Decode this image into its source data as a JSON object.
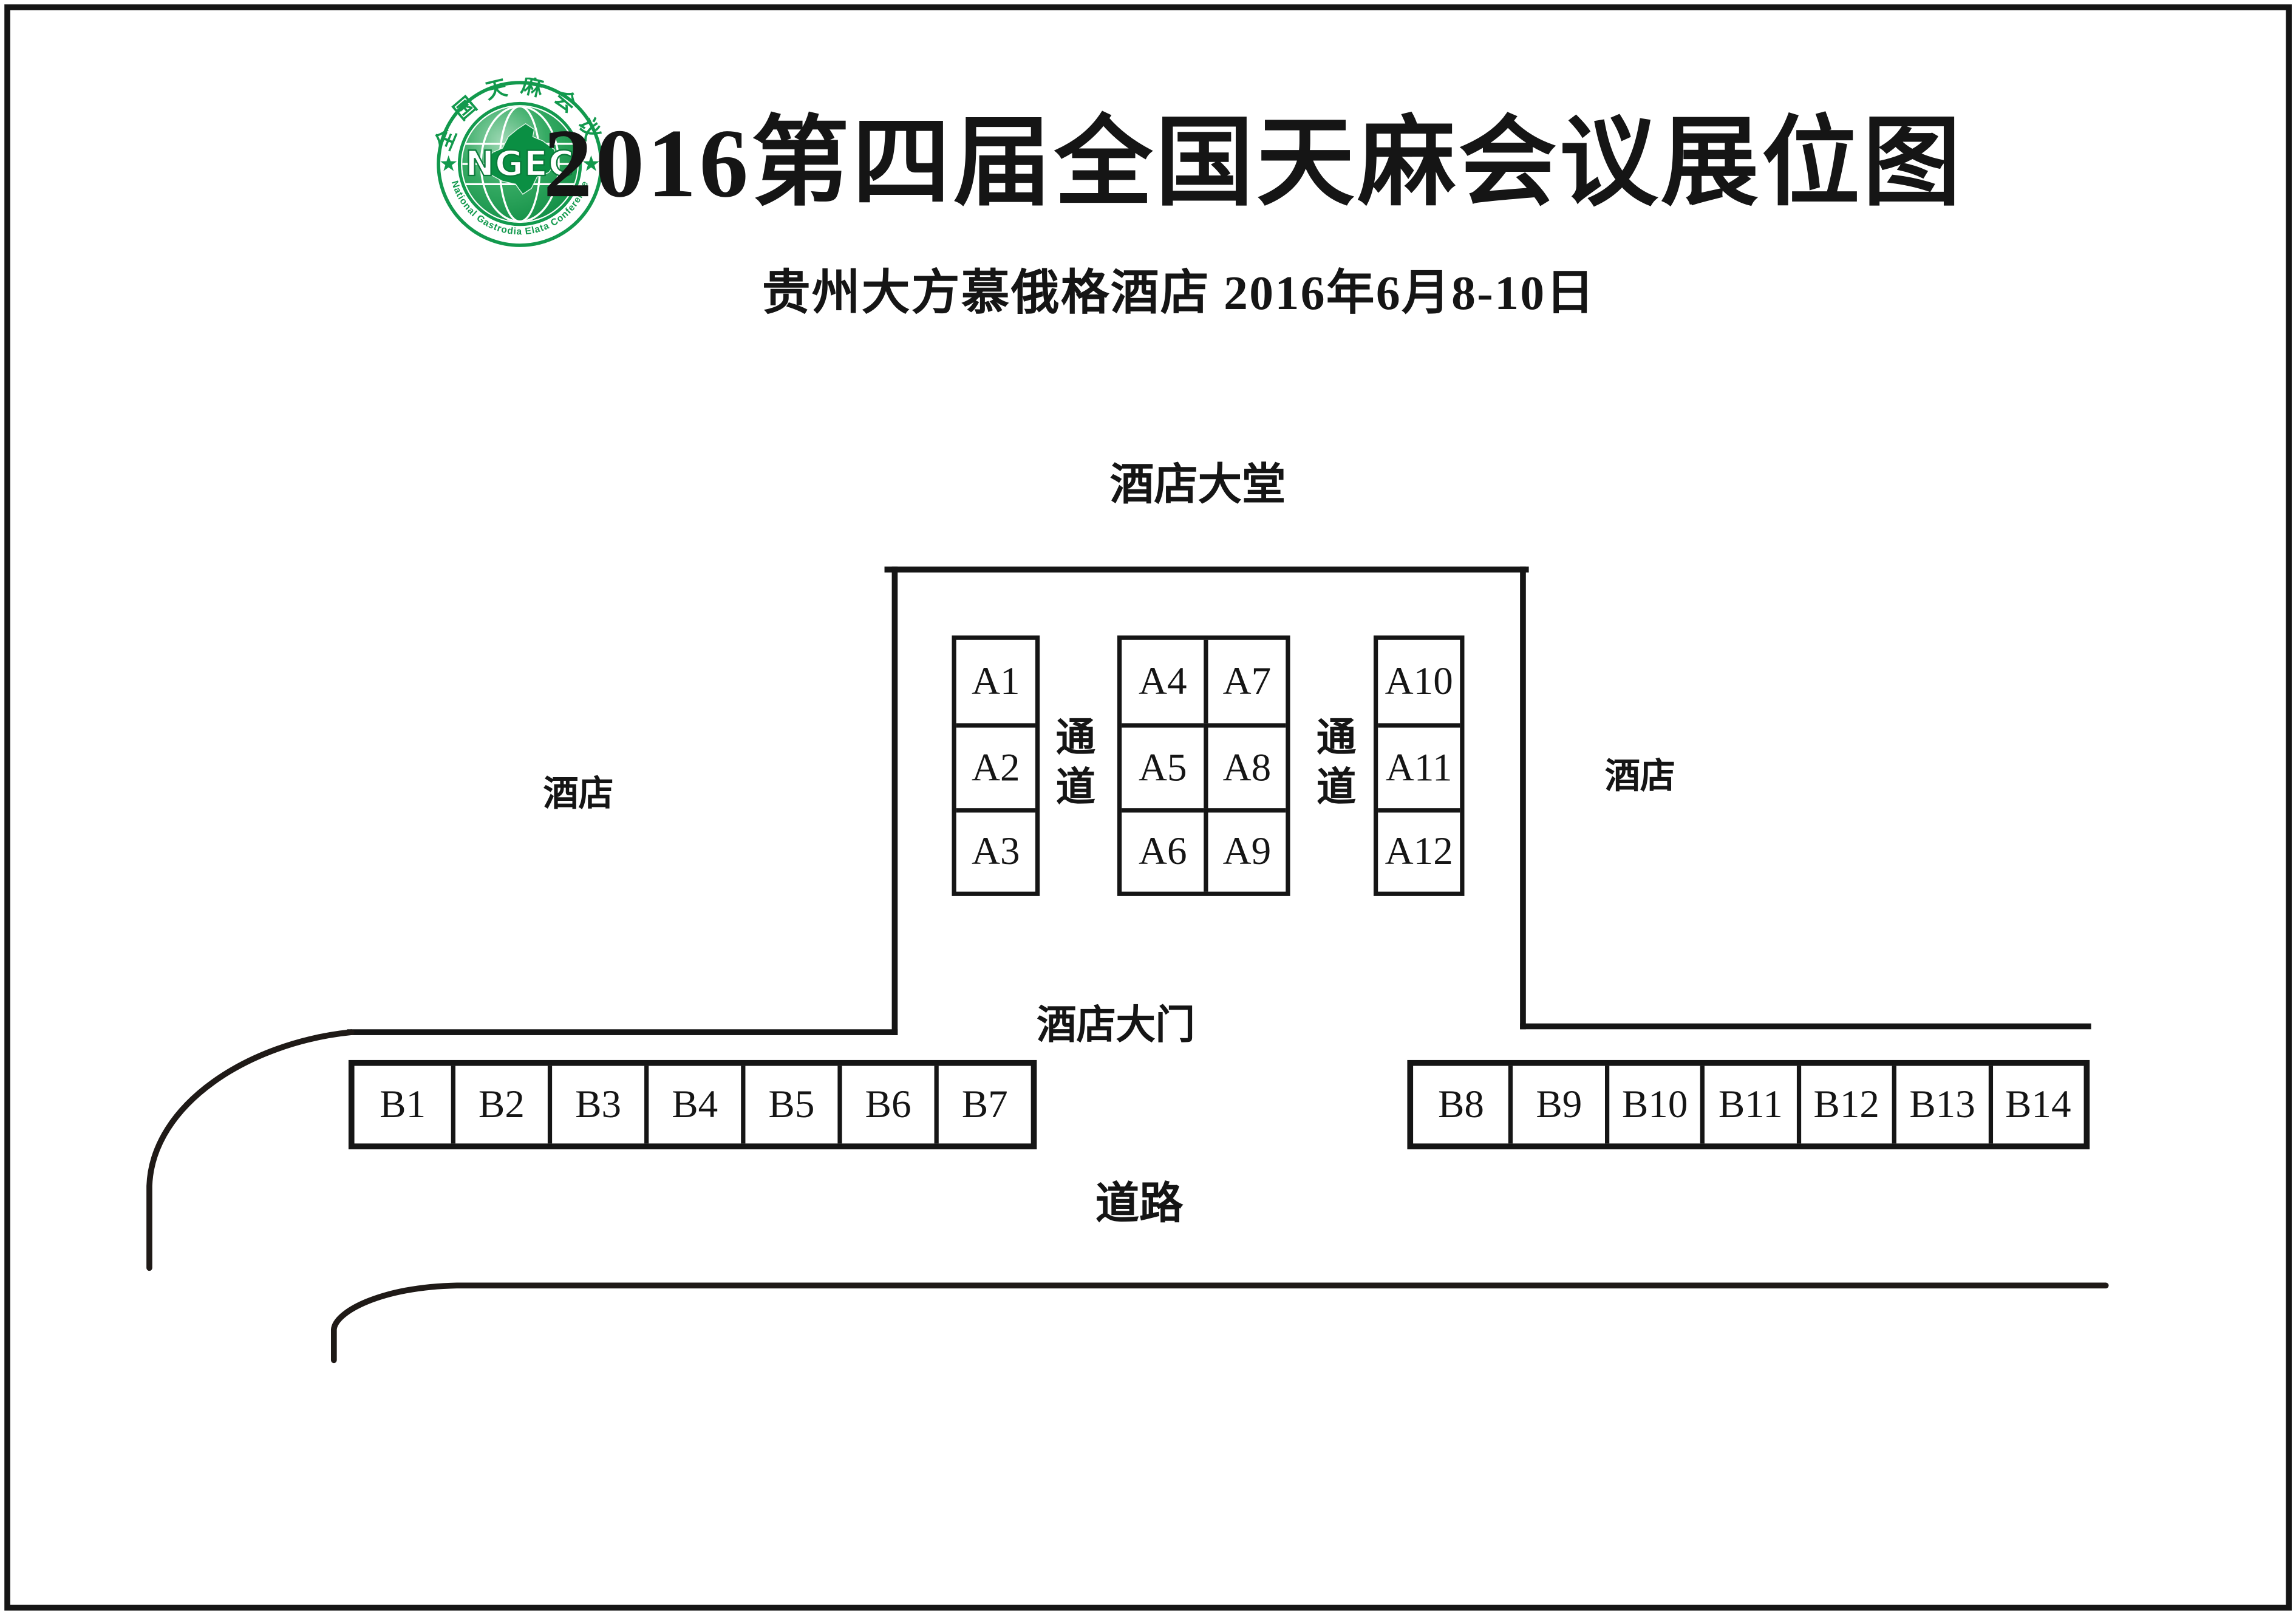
{
  "header": {
    "title": "2016第四届全国天麻会议展位图",
    "subtitle": "贵州大方慕俄格酒店  2016年6月8-10日",
    "logo": {
      "abbr": "NGEC",
      "ring_text_top": "全国天麻会议",
      "ring_text_bottom": "National Gastrodia Elata Conference",
      "color": "#12994d"
    }
  },
  "plan": {
    "lobby_label": "酒店大堂",
    "hotel_label_left": "酒店",
    "hotel_label_right": "酒店",
    "aisle_label_left": "通道",
    "aisle_label_right": "通道",
    "gate_label": "酒店大门",
    "road_label": "道路",
    "booths_a_col1": [
      "A1",
      "A2",
      "A3"
    ],
    "booths_a_col2": [
      "A4",
      "A5",
      "A6"
    ],
    "booths_a_col3": [
      "A7",
      "A8",
      "A9"
    ],
    "booths_a_col4": [
      "A10",
      "A11",
      "A12"
    ],
    "booths_b_left": [
      "B1",
      "B2",
      "B3",
      "B4",
      "B5",
      "B6",
      "B7"
    ],
    "booths_b_right": [
      "B8",
      "B9",
      "B10",
      "B11",
      "B12",
      "B13",
      "B14"
    ]
  },
  "colors": {
    "line": "#151515",
    "logo_green": "#12994d",
    "background": "#ffffff"
  }
}
